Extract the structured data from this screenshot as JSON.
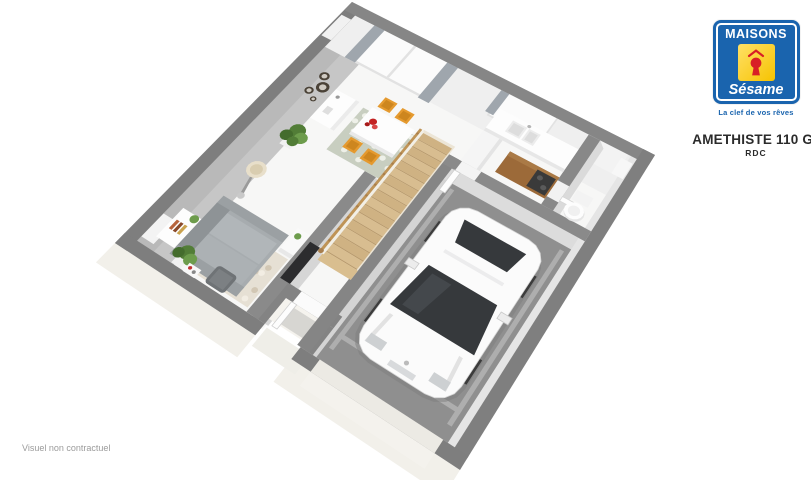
{
  "branding": {
    "name": "MAISONS",
    "script_name": "Sésame",
    "tagline": "La clef de vos rêves",
    "logo_blue": "#1a64ae",
    "logo_yellow": "#f6c300",
    "keyhole_red": "#d81f26"
  },
  "plan": {
    "title": "AMETHISTE 110 GI",
    "floor_label": "RDC"
  },
  "footer": {
    "disclaimer": "Visuel non contractuel"
  },
  "colors": {
    "wall_top": "#7e7e7e",
    "wall_top_light": "#8a8a8a",
    "wall_face_nw": "#c6c6c6",
    "wall_face_nw_dark": "#b9b9b9",
    "wall_face_inner": "#d6d6d6",
    "ne_face": "#efefef",
    "floor": "#f7f7f6",
    "garage_floor": "#8f8f8f",
    "garage_stripe": "#aeaeae",
    "exterior_face": "#f2f0ea",
    "porch_step": "#efeee8",
    "doormat": "#d7d6d2",
    "window": "#fbfbfb",
    "window_frame": "#e2e2e2",
    "curtain": "#9fa6ad",
    "wood_tread": "#d8bd90",
    "wood_tread_dark": "#cfb283",
    "wood_nosing": "#b99a6b",
    "handrail": "#bf9457",
    "stair_bg": "#ece5d6",
    "rug_dining": "#c8cec0",
    "rug_dining_leaf": "#eef0e8",
    "rug_living": "#e6e0d4",
    "rug_living_dot": "#d2c7b4",
    "rug_living_dot2": "#f2ede3",
    "table": "#fdfdfd",
    "table_edge": "#e9e9e9",
    "chair": "#e59a2f",
    "chair_dark": "#cd861f",
    "sofa": "#a7acaf",
    "sofa_dark": "#8e9396",
    "sofa_light": "#b1b6b9",
    "sofa_arm": "#9ba0a3",
    "pouf": "#6f7376",
    "pouf_light": "#7c8083",
    "plant": "#527d37",
    "plant_light": "#6d9c4c",
    "plant_dark": "#446c2d",
    "pot": "#f1f1f1",
    "cabinet_wood": "#9c6a39",
    "cabinet_wood_light": "#aa7a46",
    "cooktop": "#3a3a3a",
    "burner": "#5a5a5a",
    "tv": "#2c2c2e",
    "mirror": "#4a4237",
    "mirror_inner": "#cfcac2",
    "lamp_shade": "#e8dfca",
    "lamp_inner": "#d9cdb0",
    "car_body": "#fbfbfb",
    "car_trim": "#d5d5d5",
    "car_glass": "#36393c",
    "car_glass_hi": "#4a4e52",
    "car_detail": "#cdd0d2",
    "car_shadow": "#7d7d7d",
    "wheel": "#3c3c3c",
    "flower": "#c32222",
    "flower_light": "#d84848",
    "flower_dark": "#a81a1a",
    "white": "#fdfdfd",
    "soft_white": "#f3f3f3",
    "shade": "#e7e7e7"
  }
}
